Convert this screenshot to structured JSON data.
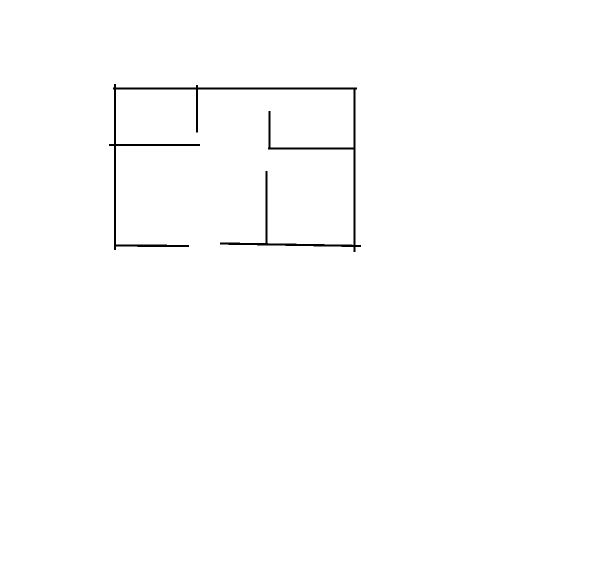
{
  "canvas": {
    "width": 600,
    "height": 584,
    "background": "#ffffff",
    "stroke_color": "#000000",
    "stroke_width": 2.2,
    "description": "Hand-drawn floor plan sketch: outer rectangle with interior partition walls and door gaps"
  },
  "sketch": {
    "lines": [
      {
        "name": "outer-wall-top",
        "x1": 113,
        "y1": 88.5,
        "x2": 357,
        "y2": 88.5
      },
      {
        "name": "outer-wall-left",
        "x1": 115,
        "y1": 84,
        "x2": 115,
        "y2": 250
      },
      {
        "name": "outer-wall-right",
        "x1": 354.5,
        "y1": 88,
        "x2": 354.5,
        "y2": 252
      },
      {
        "name": "top-divider-vertical",
        "x1": 197,
        "y1": 85,
        "x2": 197,
        "y2": 132.5
      },
      {
        "name": "left-room-partition-horizontal",
        "x1": 109,
        "y1": 145,
        "x2": 200,
        "y2": 145
      },
      {
        "name": "right-room-partition-vertical",
        "x1": 269.5,
        "y1": 111,
        "x2": 269.5,
        "y2": 148
      },
      {
        "name": "right-room-partition-horizontal",
        "x1": 268,
        "y1": 148.5,
        "x2": 354,
        "y2": 148.5
      },
      {
        "name": "lower-divider-vertical",
        "x1": 266.5,
        "y1": 171,
        "x2": 266.5,
        "y2": 244
      },
      {
        "name": "outer-wall-bottom-left-segment",
        "x1": 114,
        "y1": 245.5,
        "x2": 189,
        "y2": 246
      },
      {
        "name": "outer-wall-bottom-right-segment",
        "x1": 220,
        "y1": 243.5,
        "x2": 361,
        "y2": 246
      }
    ]
  }
}
